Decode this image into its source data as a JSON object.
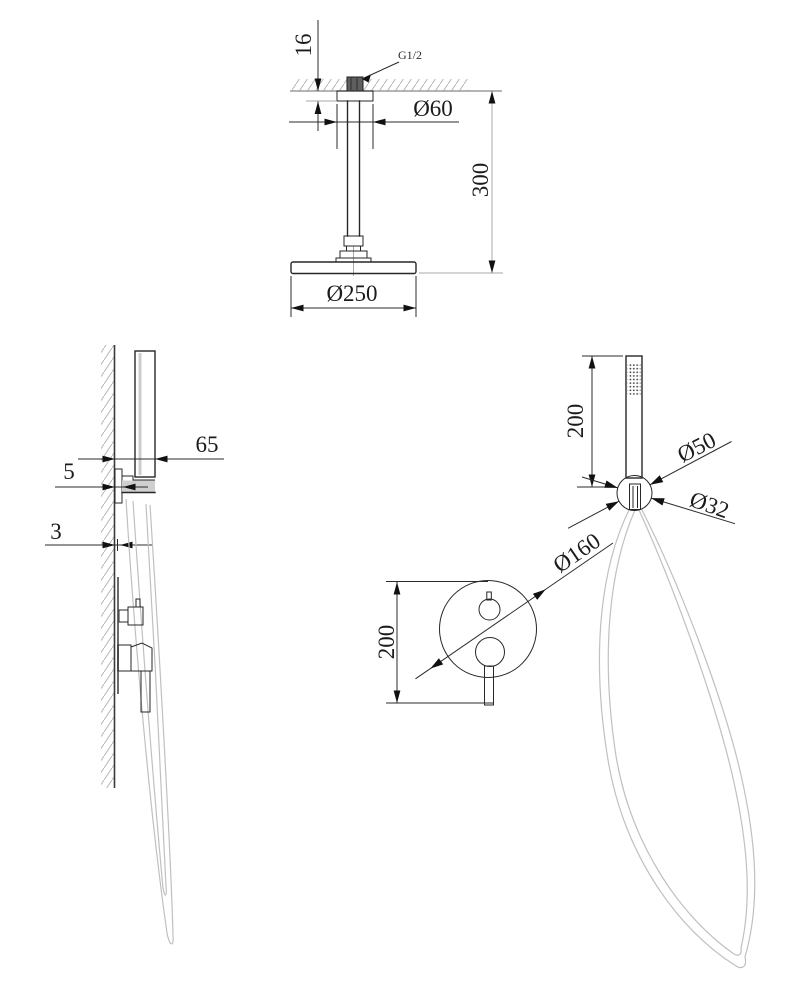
{
  "drawing": {
    "kind": "shower-set-installation-dimension-drawing",
    "dims": {
      "top": {
        "gap": "16",
        "thread": "G1/2",
        "flange": "Ø60",
        "drop": "300",
        "head": "Ø250"
      },
      "side": {
        "offset": "65",
        "plate": "5",
        "hose": "3"
      },
      "hand": {
        "length": "200",
        "holder": "Ø50",
        "wand": "Ø32"
      },
      "mixer": {
        "height": "200",
        "plate": "Ø160"
      }
    },
    "colors": {
      "line": "#272727",
      "dimension": "#2b2b2b",
      "gray_accent": "#9b9b9b",
      "hatch": "#b4b4b4",
      "hose": "#c0c0c0",
      "background": "#ffffff"
    }
  }
}
